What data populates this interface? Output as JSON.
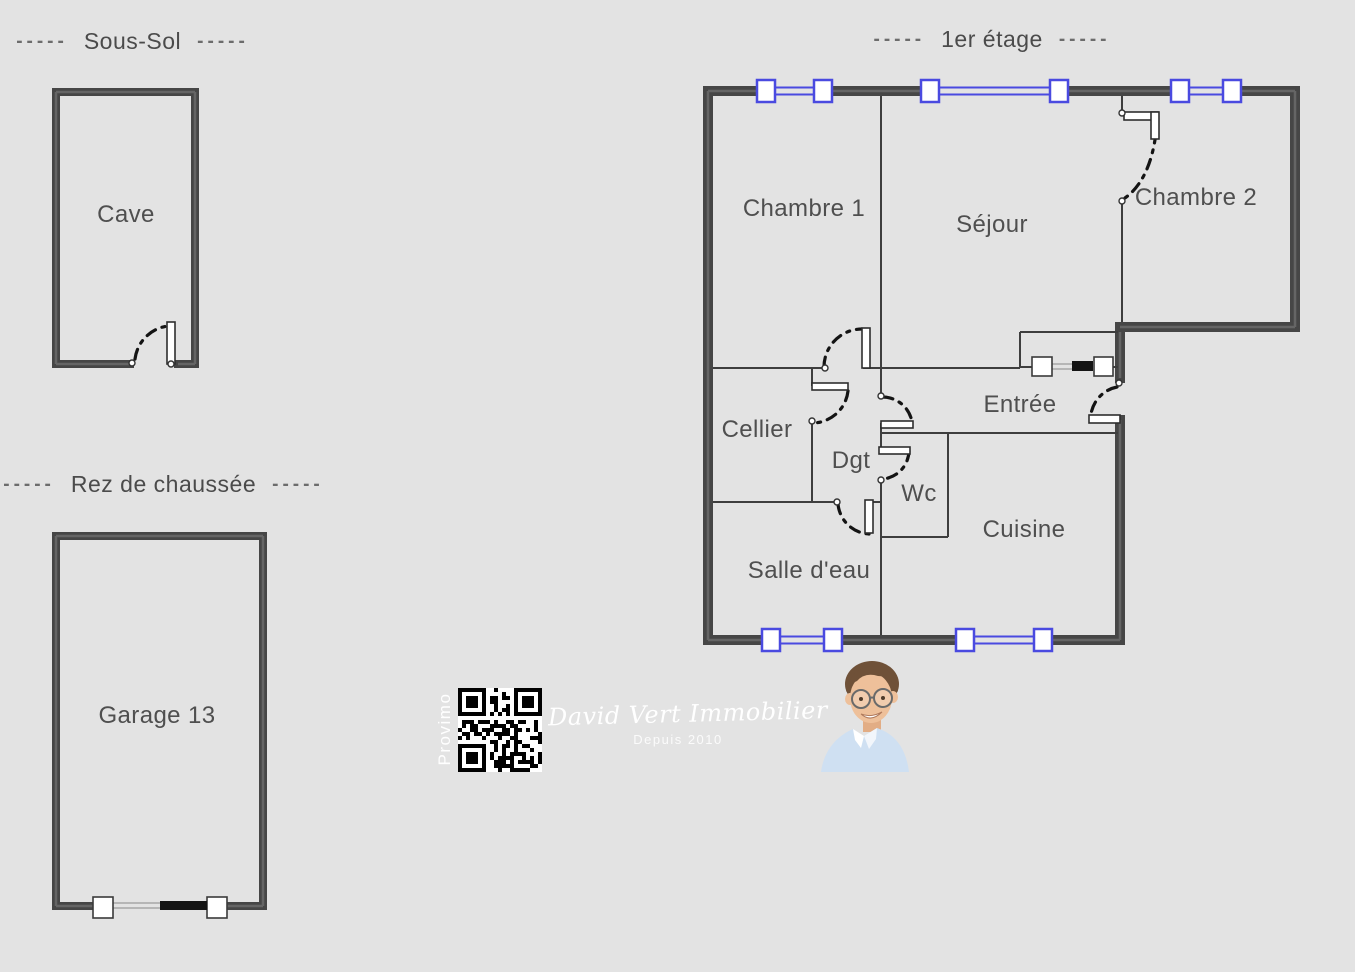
{
  "titles": {
    "dash": "-----",
    "sous_sol": "Sous-Sol",
    "rez_de_chaussee": "Rez de chaussée",
    "premier_etage": "1er étage"
  },
  "rooms": {
    "cave": "Cave",
    "garage": "Garage 13",
    "chambre1": "Chambre 1",
    "sejour": "Séjour",
    "chambre2": "Chambre 2",
    "cellier": "Cellier",
    "degagement": "Dgt",
    "wc": "Wc",
    "entree": "Entrée",
    "cuisine": "Cuisine",
    "salle_deau": "Salle d'eau"
  },
  "branding": {
    "vertical_label": "Provimo",
    "agency_name": "David Vert Immobilier",
    "tagline": "Depuis 2010"
  },
  "colors": {
    "background": "#e3e3e3",
    "wall": "#464646",
    "thin_wall": "#3e3e3e",
    "window_blue": "#4a4ae0",
    "label_text": "#4f4f4f",
    "logo_text": "#ffffff"
  }
}
